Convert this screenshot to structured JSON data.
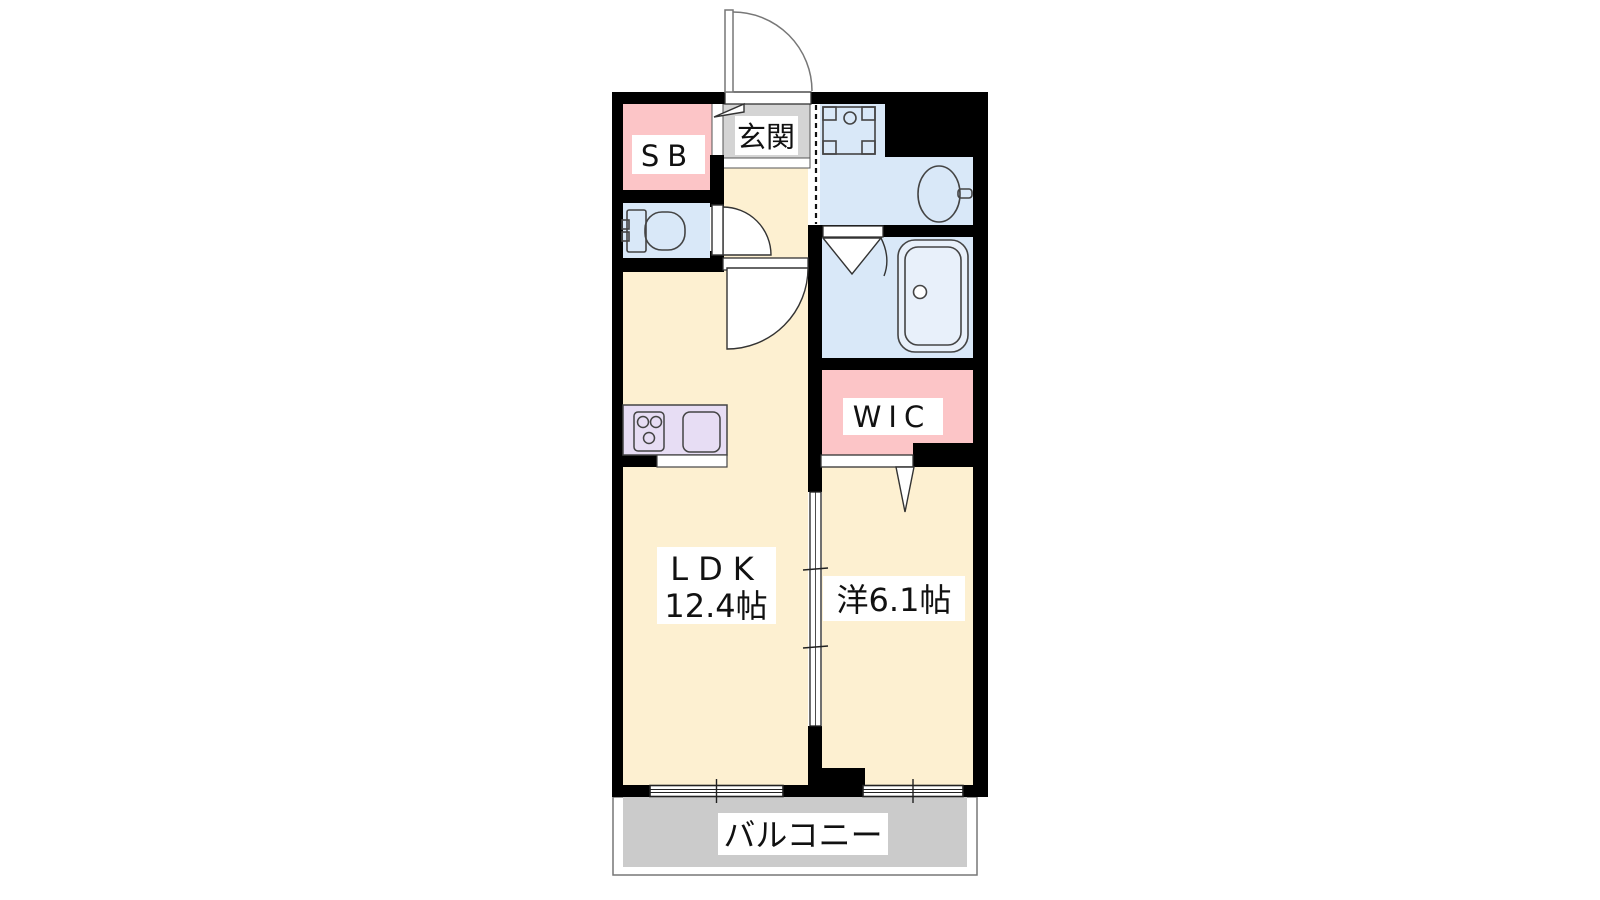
{
  "plan": {
    "type": "apartment-floor-plan-1LDK",
    "rooms": {
      "shoe_box": {
        "label": "SB"
      },
      "entrance": {
        "label": "玄関"
      },
      "ldk": {
        "label": "LDK",
        "size": "12.4帖"
      },
      "western_room": {
        "label": "洋6.1帖"
      },
      "wic": {
        "label": "WIC"
      },
      "balcony": {
        "label": "バルコニー"
      }
    },
    "fixtures": [
      "toilet",
      "bathtub",
      "wash-basin",
      "washing-machine-pan",
      "kitchen-stove",
      "kitchen-sink"
    ],
    "colors": {
      "wall": "#000000",
      "floor_cream": "#fdf0d1",
      "water_blue": "#d9e8f8",
      "closet_pink": "#fcc5c7",
      "kitchen_purple": "#e7ddf4",
      "entrance_gray": "#d4d4d4",
      "balcony_gray": "#cbcbcb",
      "label_bg": "#ffffff",
      "line": "#333333",
      "background": "#ffffff"
    }
  }
}
